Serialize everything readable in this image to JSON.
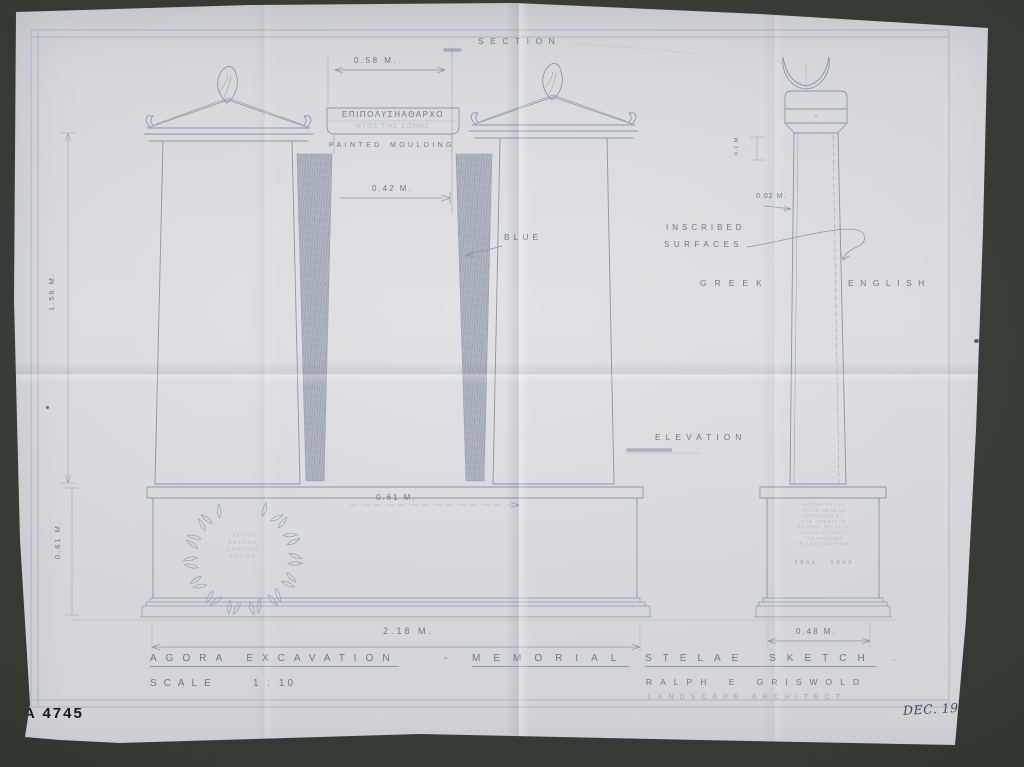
{
  "sheet": {
    "catalog_number": "A 4745",
    "date_note": "DEC. 1953"
  },
  "views": {
    "section_label": "SECTION",
    "elevation_label": "ELEVATION"
  },
  "annotations": {
    "painted_moulding": "PAINTED MOULDING",
    "blue": "BLUE",
    "inscribed_line1": "INSCRIBED",
    "inscribed_line2": "SURFACES",
    "greek": "GREEK",
    "english": "ENGLISH"
  },
  "dimensions": {
    "cap_width": "0.58 M.",
    "shaft_width": "0.42 M.",
    "inscription_depth": "0.02 M.",
    "cap_height": "0.1 M.",
    "shaft_height": "1.56 M.",
    "base_height": "0.61 M.",
    "base_panel_width": "0.61 M.",
    "base_total_width": "2.18 M.",
    "pedestal_width": "0.48 M."
  },
  "inscriptions": {
    "moulding_greek": "ΕΠΙΠΟΛΥΣΗΑΘΑΡΧΟ",
    "moulding_greek_faint": "ΝΤΟΣ ΤΗΣ ΣΩΝΗΣ",
    "wreath_lines": [
      "ΙΑΣΤΠΟ",
      "ΕΑΕΛΝΕ",
      "ΕΑΗΙΣΗΝ",
      "ΕΡΣΙΑΩ"
    ],
    "pedestal_lines": [
      "AGORA EXCAV",
      "ATION RESEAR",
      "FINANCED BY",
      "THE AMERICAN",
      "SCHOOL OF CLAS",
      "SICAL STUDIES",
      "ITS FRIENDS",
      "IN CONTINUATION"
    ],
    "pedestal_dates": "1951 · 1953"
  },
  "title_block": {
    "title_part1": "AGORA EXCAVATION",
    "separator": "-",
    "title_part2": "MEMORIAL",
    "title_part3": "STELAE SKETCH",
    "title_period": ".",
    "scale_label": "SCALE",
    "scale_value": "1 : 10",
    "architect": "RALPH E GRISWOLD",
    "architect_title": "LANDSCAPE ARCHITECT"
  },
  "colors": {
    "backdrop": "#3a3e39",
    "paper": "#d8dade",
    "pencil": "#636b79",
    "blue_shading": "#aeb4be",
    "ink": "#17191d",
    "handwriting": "#464b55"
  }
}
